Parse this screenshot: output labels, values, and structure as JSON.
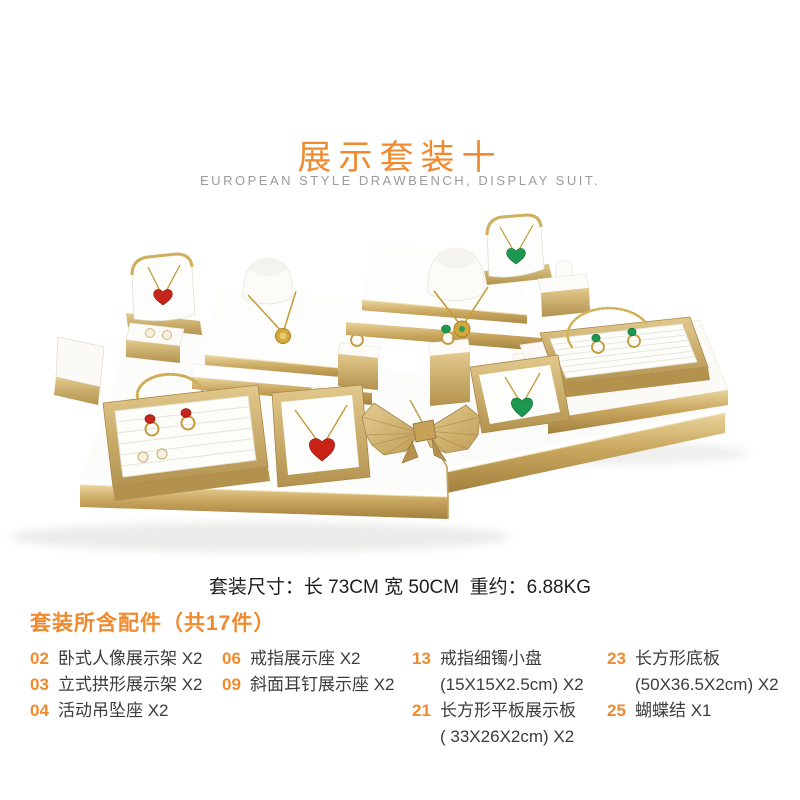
{
  "page": {
    "title": "展示套装十",
    "subtitle": "EUROPEAN STYLE DRAWBENCH, DISPLAY SUIT.",
    "dimensions_line": "套装尺寸：长 73CM 宽 50CM  重约：6.88KG",
    "parts_header": "套装所含配件（共17件）"
  },
  "photo": {
    "label": "gold-white-jewelry-display-set-photo",
    "colors": {
      "gold": "#c8a55e",
      "gold_light": "#e6cf96",
      "gold_dark": "#a8874a",
      "surface_white": "#fdfdfb",
      "red_jewel": "#c5261b",
      "green_jewel": "#1b9750",
      "chain_gold": "#c49a38",
      "pearl": "#f6f0e0"
    }
  },
  "colors": {
    "accent_orange": "#ef8a2e",
    "text_dark": "#1f1f1f",
    "text_gray": "#9b9b9b",
    "list_text": "#3c3c3c"
  },
  "parts": {
    "columns": [
      {
        "items": [
          {
            "num": "02",
            "text": "卧式人像展示架 X2"
          },
          {
            "num": "03",
            "text": "立式拱形展示架 X2"
          },
          {
            "num": "04",
            "text": "活动吊坠座 X2"
          }
        ]
      },
      {
        "items": [
          {
            "num": "06",
            "text": "戒指展示座 X2"
          },
          {
            "num": "09",
            "text": "斜面耳钉展示座 X2"
          }
        ]
      },
      {
        "items": [
          {
            "num": "13",
            "text": "戒指细镯小盘",
            "sub": "(15X15X2.5cm) X2"
          },
          {
            "num": "21",
            "text": "长方形平板展示板",
            "sub": "( 33X26X2cm) X2"
          }
        ]
      },
      {
        "items": [
          {
            "num": "23",
            "text": "长方形底板",
            "sub": "(50X36.5X2cm) X2"
          },
          {
            "num": "25",
            "text": "蝴蝶结 X1"
          }
        ]
      }
    ]
  }
}
